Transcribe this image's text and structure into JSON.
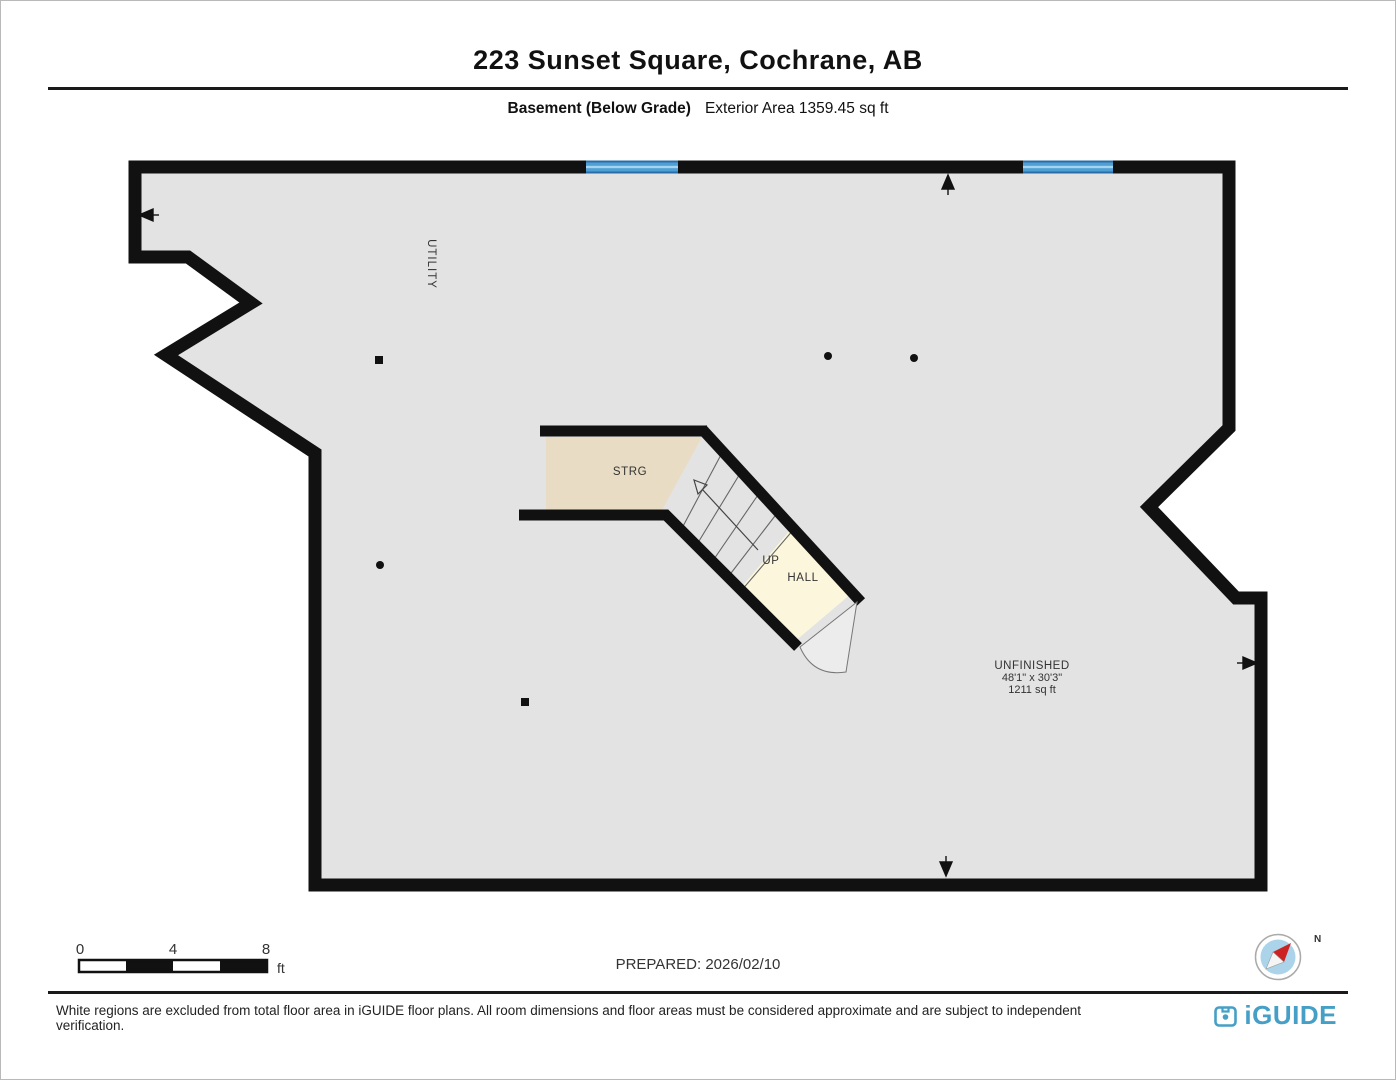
{
  "header": {
    "title": "223 Sunset Square, Cochrane, AB",
    "floor_name": "Basement (Below Grade)",
    "exterior_area": "Exterior Area 1359.45 sq ft"
  },
  "plan": {
    "rooms": {
      "utility": "UTILITY",
      "storage": "STRG",
      "stair_direction": "UP",
      "hall": "HALL",
      "unfinished": {
        "name": "UNFINISHED",
        "dimensions": "48'1\" x 30'3\"",
        "area": "1211 sq ft"
      }
    },
    "colors": {
      "wall": "#111111",
      "floor": "#e3e3e3",
      "storage_floor": "#e9dcc4",
      "hall_floor": "#fcf7dc",
      "window_blue": "#4d9fd4",
      "brand_blue": "#459fc6"
    }
  },
  "scale_bar": {
    "tick_0": "0",
    "tick_4": "4",
    "tick_8": "8",
    "unit": "ft"
  },
  "prepared": "PREPARED: 2026/02/10",
  "compass": {
    "north": "N"
  },
  "footer": {
    "disclaimer": "White regions are excluded from total floor area in iGUIDE floor plans. All room dimensions and floor areas must be considered approximate and are subject to independent verification.",
    "brand": "iGUIDE"
  }
}
